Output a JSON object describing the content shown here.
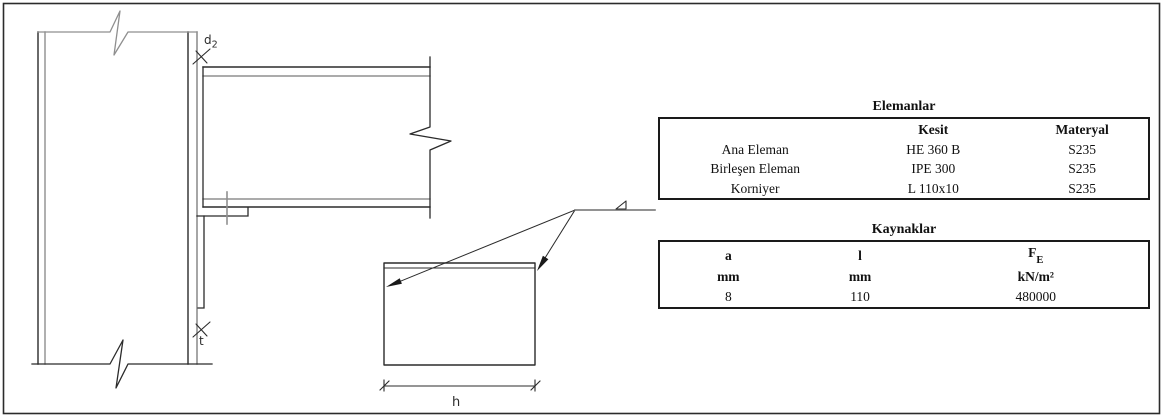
{
  "drawing": {
    "labels": {
      "d_main": "d",
      "d_sub": "2",
      "t": "t",
      "h": "h"
    }
  },
  "tables": {
    "elements": {
      "title": "Elemanlar",
      "columns": [
        "",
        "Kesit",
        "Materyal"
      ],
      "rows": [
        {
          "name": "Ana Eleman",
          "kesit": "HE 360 B",
          "materyal": "S235"
        },
        {
          "name": "Birleşen Eleman",
          "kesit": "IPE 300",
          "materyal": "S235"
        },
        {
          "name": "Korniyer",
          "kesit": "L 110x10",
          "materyal": "S235"
        }
      ]
    },
    "welds": {
      "title": "Kaynaklar",
      "header": {
        "a": "a",
        "l": "l",
        "f_main": "F",
        "f_sub": "E"
      },
      "units": {
        "a": "mm",
        "l": "mm",
        "f": "kN/m²"
      },
      "values": {
        "a": "8",
        "l": "110",
        "f": "480000"
      }
    }
  },
  "colors": {
    "line_dark": "#2b2b2b",
    "line_gray": "#8f8f8f",
    "text": "#111111"
  }
}
